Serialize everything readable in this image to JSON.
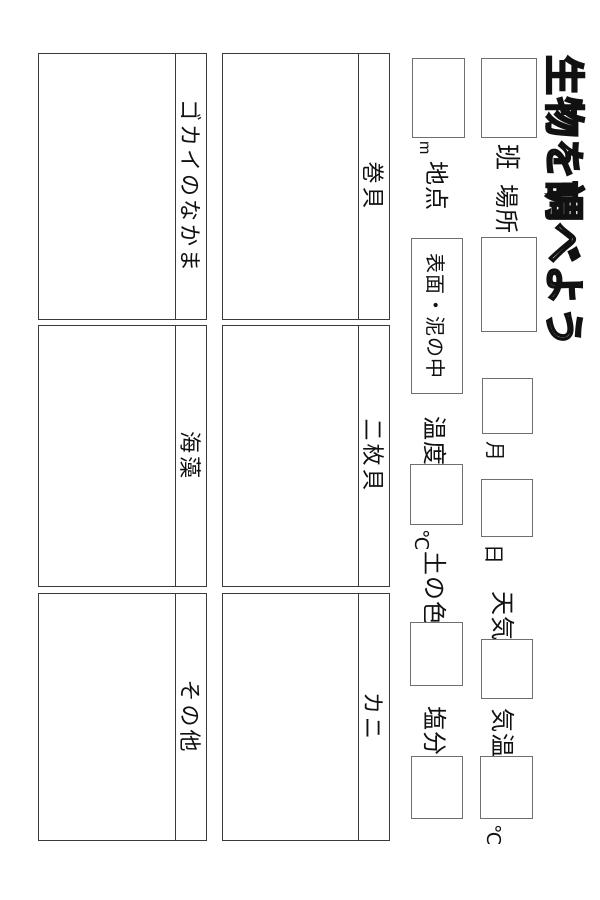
{
  "title": "生物を調べよう",
  "colors": {
    "background": "#ffffff",
    "ink": "#111111",
    "grid_border": "#3a3a3a",
    "box_border": "#6f6f6f"
  },
  "fields": {
    "han": {
      "label": "班"
    },
    "basho": {
      "label": "場所"
    },
    "month": {
      "label": "月"
    },
    "day": {
      "label": "日"
    },
    "tenki": {
      "label": "天気"
    },
    "kion": {
      "label": "気温",
      "unit": "℃"
    },
    "chiten": {
      "label": "地点",
      "unit": "m"
    },
    "surface": {
      "label": "表面・泥の中"
    },
    "ondo": {
      "label": "温度",
      "unit": "℃"
    },
    "tsuchi": {
      "label": "土の色"
    },
    "enbun": {
      "label": "塩分"
    }
  },
  "grid": {
    "cells": [
      {
        "label": "巻貝"
      },
      {
        "label": "二枚貝"
      },
      {
        "label": "カニ"
      },
      {
        "label": "ゴカイのなかま"
      },
      {
        "label": "海藻"
      },
      {
        "label": "その他"
      }
    ]
  }
}
